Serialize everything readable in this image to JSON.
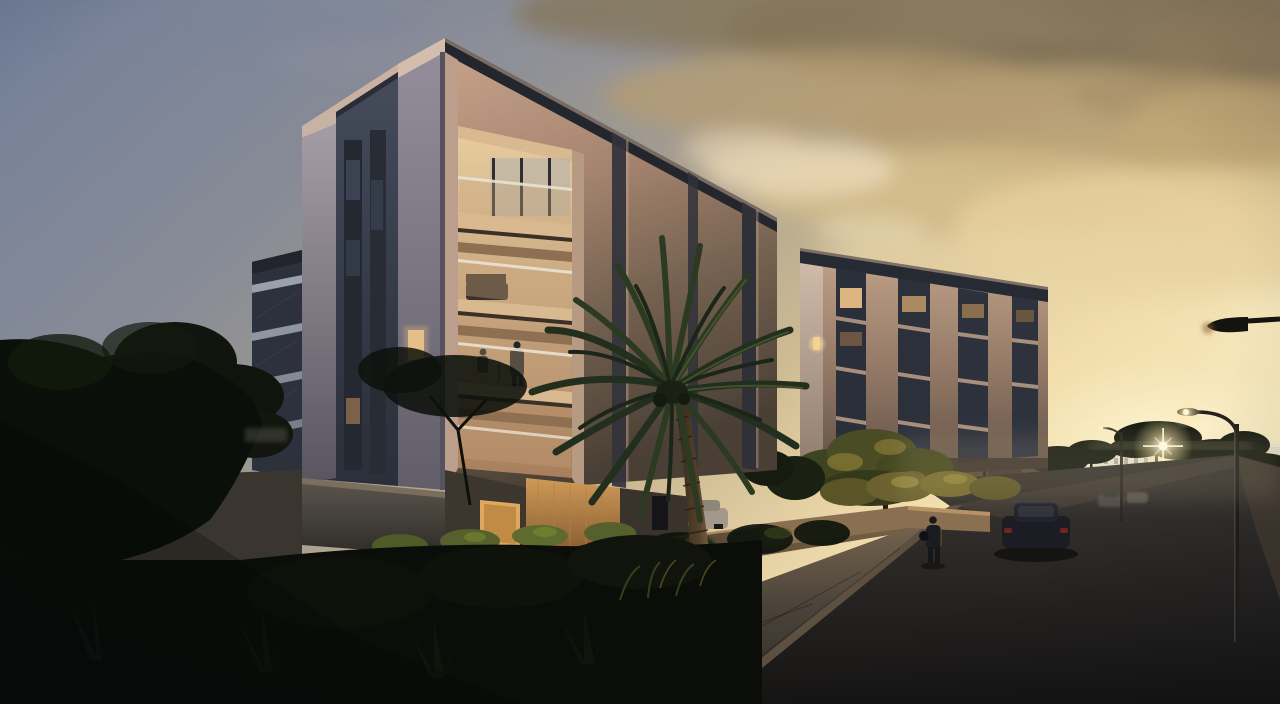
{
  "scene": {
    "type": "architectural exterior rendering",
    "time_of_day": "dusk / sunset",
    "description": "Modern four-storey apartment buildings at sunset with a large palm tree, garden walls, a street with cars and streetlights, and dark foreground vegetation",
    "objects": [
      "main apartment building with recessed lit balconies",
      "second apartment building",
      "palm tree",
      "olive tree with landscape lighting",
      "retaining wall with hanging plants",
      "street with dark sedan and distant cars",
      "parked white cars",
      "streetlights",
      "pedestrian on sidewalk",
      "couple on balcony",
      "distant white buildings and pine trees",
      "sunset sky with golden clouds"
    ]
  },
  "palette": {
    "sky1": "#72809a",
    "sky2": "#878b96",
    "sky3": "#a69e8f",
    "sky4": "#cfbc94",
    "sky5": "#eedaab",
    "sky6": "#f9efce",
    "cloud_dark": "#84755a",
    "cloud_mid": "#b59c72",
    "cloud_gold": "#e6cf9b",
    "sun_glow": "#fff7d9",
    "lamp_glow": "#ffeec8",
    "bldg_tan": "#c79f88",
    "bldg_dark_face": "#3f4654",
    "balcony_glow": "#ecd2a6",
    "road_top": "#3a3633",
    "road_bottom": "#161514",
    "veg_dark": "#0b0f09"
  }
}
